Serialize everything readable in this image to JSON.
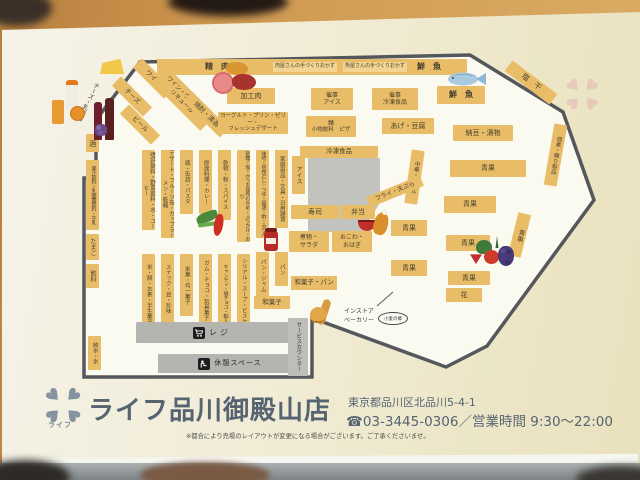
{
  "map": {
    "top_band": {
      "seiniku": "精　肉",
      "meat_side": "肉屋さんの手づくりおかず",
      "fish_side": "魚屋さんの手づくりおかず",
      "sengyo": "鮮　魚"
    },
    "corner_labels": {
      "cheese_dairy": "チーズ・乳製品",
      "shioboshi": "塩　干",
      "tsukudani": "佃煮・練り製品"
    },
    "liquor": {
      "cheese": "チーズ",
      "wine": "ワイン",
      "beer": "ビール",
      "whisky_1": "ワイン・ウイスキー",
      "whisky_2": "リキュール",
      "shochu": "焼酎・清酒",
      "sake": "酒"
    },
    "left_wall": {
      "juice_milk": "果汁飲料・乳酸菌飲料・牛乳",
      "eggs": "たまご",
      "drinks": "飲料",
      "water_ice": "純水・氷"
    },
    "deli": {
      "processed_meat": "加工肉",
      "event_ice": {
        "l1": "催事",
        "l2": "アイス"
      },
      "event_frozen": {
        "l1": "催事",
        "l2": "冷凍食品"
      },
      "yogurt_1": "ヨーグルト・プリン・ゼリー・",
      "yogurt_2": "フレッシュデザート",
      "noodle": "麺",
      "small_drinks": "小物飲料",
      "pizza": "ピザ",
      "age_tofu": "あげ・豆腐",
      "natto": "納豆・漬物",
      "frozen": "冷凍食品",
      "sengyo2": "鮮　魚",
      "ice_v": "アイス",
      "chuka": "中華・グリル",
      "fry": "フライ・天ぷら",
      "sushi": "寿司",
      "bento": "弁当",
      "nimono_1": "煮物・",
      "nimono_2": "サラダ",
      "okowa_1": "おこわ・",
      "okowa_2": "おはぎ"
    },
    "produce": {
      "seika": "青果",
      "flower": "花"
    },
    "aisles_upper": [
      "嗜好飲料・野菜飲料・水・コーヒー",
      "デザート・フルーツ缶・カップラーメン・乾麺",
      "瓶・缶詰・パスタ",
      "即席料理・カレー",
      "乾物・粉・スパイス",
      "砂糖・塩・かつお昆布わかめ・ふりかけ・のり",
      "味噌・昆布だし・つゆ・醤油・酢・みりん",
      "家庭用品・文具・日用雑貨"
    ],
    "aisles_lower": [
      "米・餅・お茶・半生菓子",
      "スナック・豆・珍味",
      "米菓・均一菓子",
      "ガム・チョコ・玩具菓子",
      "キャンディ・袋チョコ・輸入菓子",
      "シリアル・スープ・ビスケット",
      "パン・ジャム",
      "パン"
    ],
    "bakery": {
      "wagashi": "和菓子",
      "wagashi_pan": "和菓子・パン",
      "instore_1": "インストア",
      "instore_2": "ベーカリー",
      "komugi": "小麦の郷"
    },
    "facilities": {
      "regi": "レジ",
      "rest": "休憩スペース",
      "service": "サービスカウンター"
    }
  },
  "footer": {
    "store_name": "ライフ品川御殿山店",
    "logo_text": "ライフ",
    "address": "東京都品川区北品川5-4-1",
    "phone_hours": "☎03-3445-0306／営業時間 9:30～22:00",
    "note": "※都合により売場のレイアウトが変更になる場合がございます。ご了承くださいませ。"
  },
  "colors": {
    "block_yellow": "#e9bd67",
    "wall_gray": "#54575b",
    "facility_gray": "#b4b4b0",
    "footer_blue": "#566472",
    "desk_tan": "#cf9a52"
  }
}
